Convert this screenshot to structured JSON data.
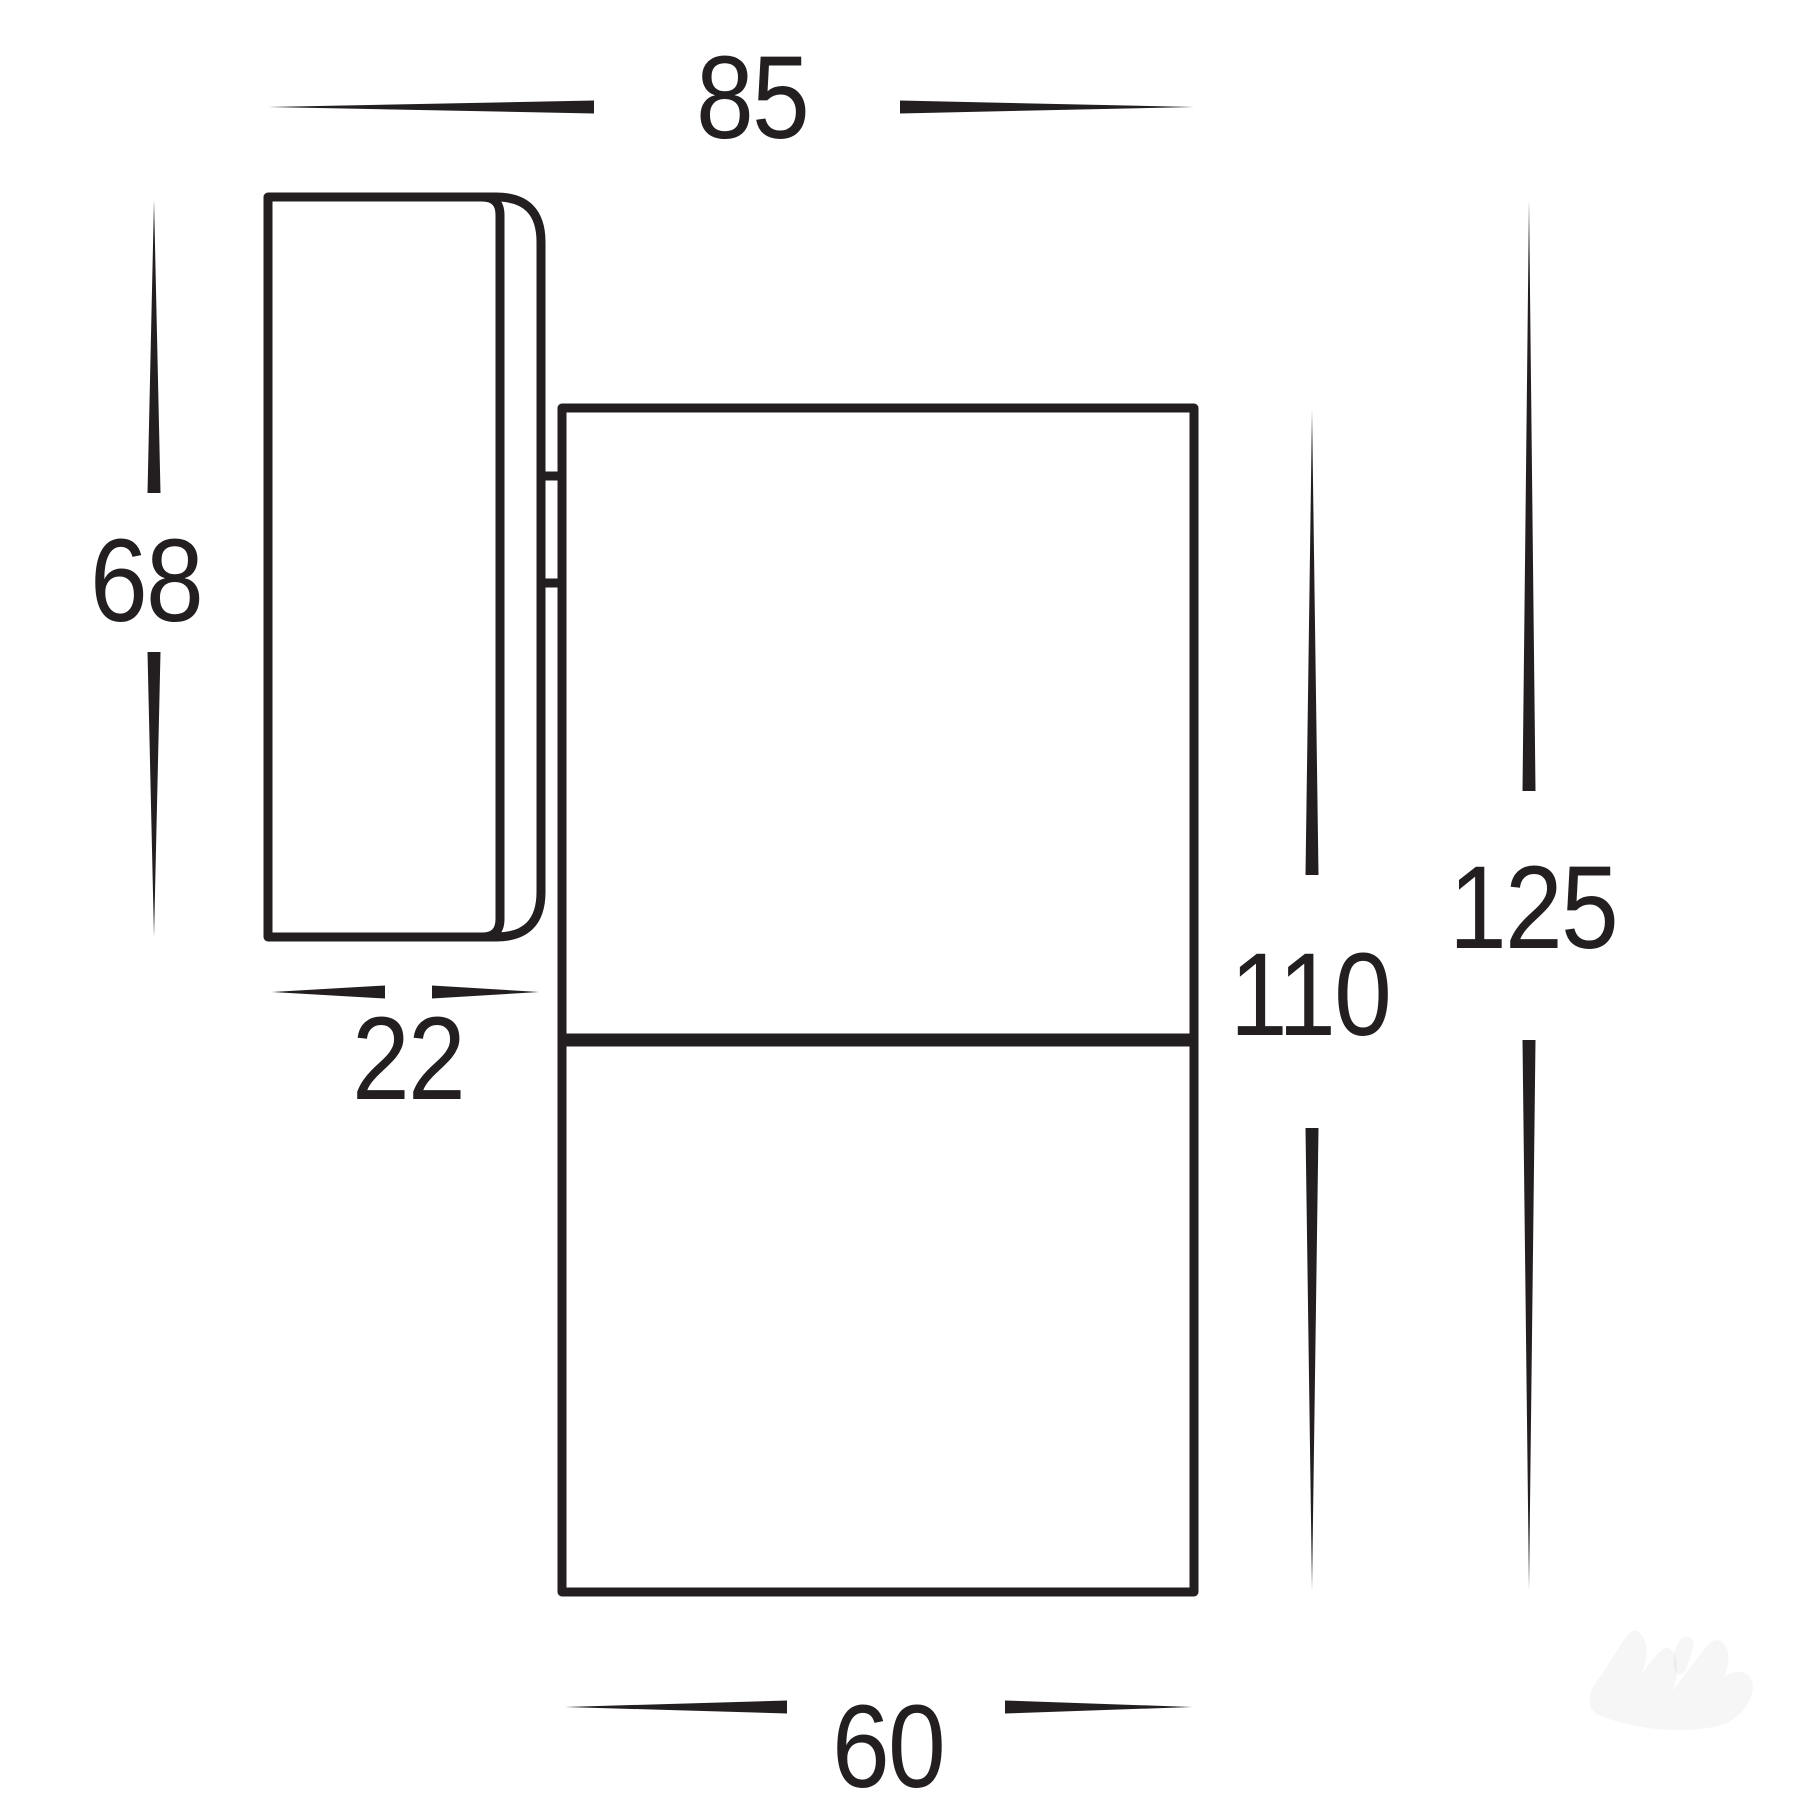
{
  "diagram": {
    "kind": "technical-dimension-drawing",
    "line_color": "#231f20",
    "background_color": "#ffffff",
    "dimensions": {
      "top_width": "85",
      "plate_height": "68",
      "plate_depth": "22",
      "body_height": "110",
      "overall_height": "125",
      "body_width": "60"
    }
  }
}
